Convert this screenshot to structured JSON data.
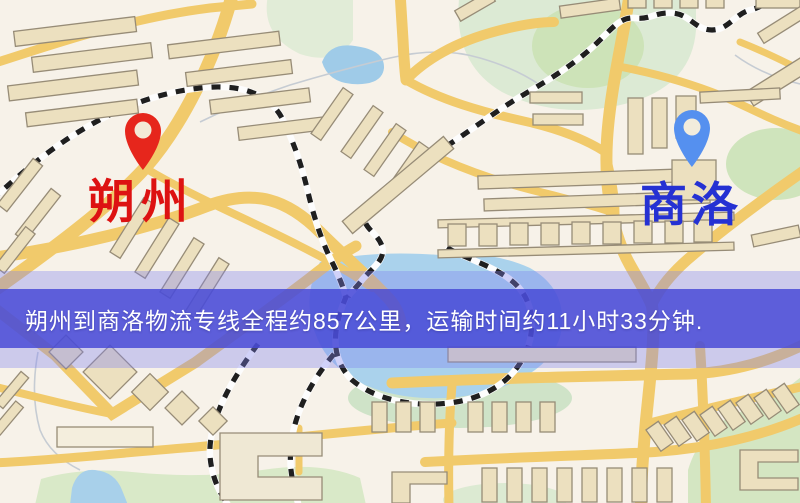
{
  "map": {
    "origin": {
      "name": "朔州",
      "marker_color": "#e6261c",
      "label_color": "#dd1212"
    },
    "destination": {
      "name": "商洛",
      "marker_color": "#5590ef",
      "label_color": "#2531d3"
    },
    "banner": {
      "text": "朔州到商洛物流专线全程约857公里，运输时间约11小时33分钟.",
      "background": "#4648d6",
      "text_color": "#ffffff"
    },
    "palette": {
      "map_background": "#f7f2e9",
      "road": "#f1ca6b",
      "water": "#a6cfea",
      "park": "#d8e8c6",
      "railway": "#1f1f1f",
      "building": "#ece0bf"
    }
  }
}
